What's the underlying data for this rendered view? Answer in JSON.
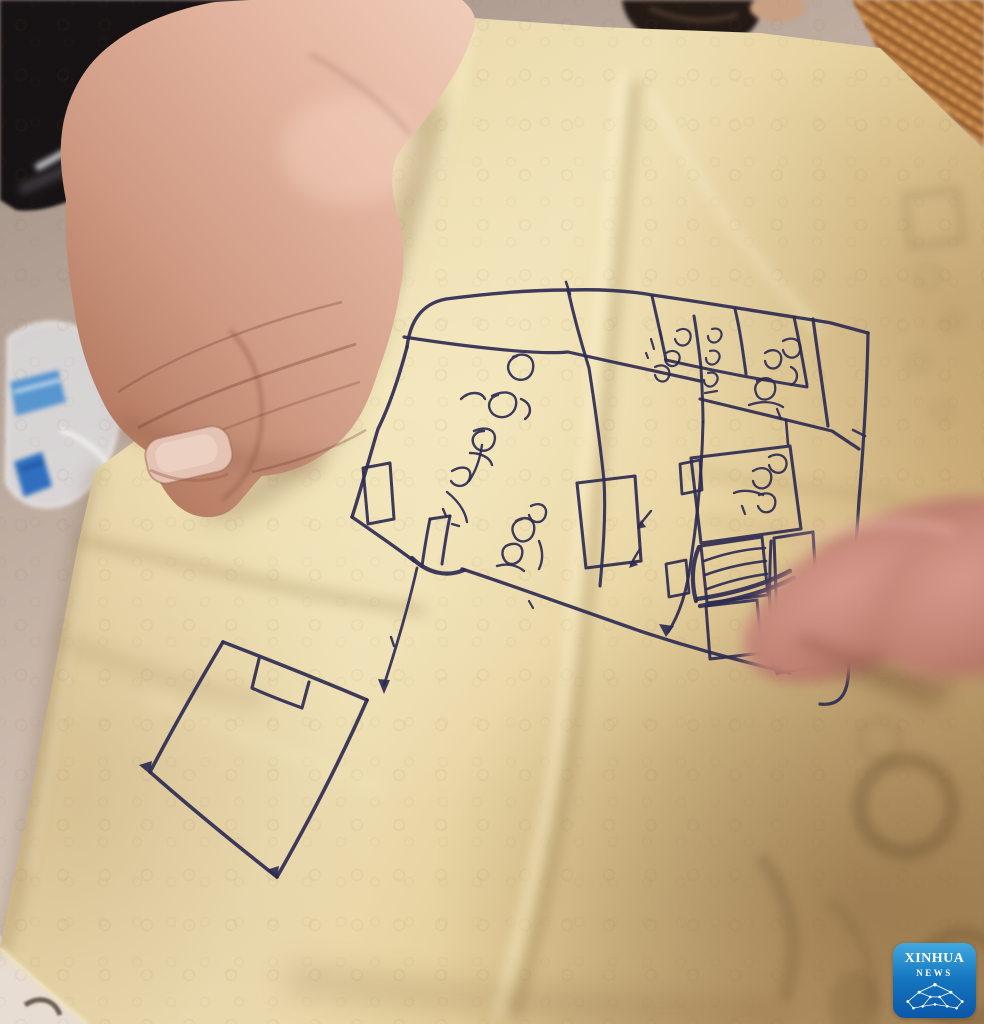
{
  "scene": {
    "subject": "hand holding a crumpled tan sheet of paper with a hand-drawn floor plan sketched in blue ballpoint ink, a blurred finger pointing at the sketch",
    "annotation_note": "room labels are illegible handwritten Burmese script"
  },
  "watermark": {
    "line1": "XINHUA",
    "line2": "NEWS"
  },
  "palette": {
    "ink": "#2e2b52",
    "paper": "#e6d3a4",
    "floor": "#c0aca0",
    "skin": "#d8a794",
    "hair": "#171214",
    "basket": "#b97c3f",
    "bottle_blue": "#4a8fd0",
    "logo_blue_top": "#41a8e0",
    "logo_blue_bottom": "#0b57a7",
    "ghost": "#5f4628"
  },
  "sketch": {
    "paths": [
      {
        "d": "M407,347 C410,323 420,304 446,299 C492,293 536,290 568,290",
        "w": 3.4
      },
      {
        "d": "M568,290 C602,289 630,291 652,295 C702,302 748,310 794,317 C806,319 821,321 831,323 L868,333",
        "w": 3.4
      },
      {
        "d": "M404,337 C468,347 540,355 568,352 C612,362 660,372 700,381",
        "w": 3.2
      },
      {
        "d": "M407,347 C399,377 389,407 378,429 C369,459 359,496 352,517",
        "w": 3.4
      },
      {
        "d": "M352,517 C378,535 398,549 414,561",
        "w": 3.4
      },
      {
        "d": "M462,569 C505,583 560,603 640,631 C685,646 725,657 790,673",
        "w": 3.4
      },
      {
        "d": "M568,290 C577,330 585,355 589,368 C597,420 601,450 604,481 C606,515 603,552 600,586",
        "w": 3.1
      },
      {
        "d": "M652,296 C657,318 662,340 666,360",
        "w": 3
      },
      {
        "d": "M694,316 C697,334 699,350 701,368",
        "w": 3
      },
      {
        "d": "M735,309 C740,330 743,352 746,374",
        "w": 3
      },
      {
        "d": "M794,317 C799,340 803,362 807,385",
        "w": 3
      },
      {
        "d": "M813,319 C818,355 823,392 828,426",
        "w": 3.2
      },
      {
        "d": "M666,360 C710,370 755,379 807,387",
        "w": 3
      },
      {
        "d": "M701,368 C702,386 703,404 703,422",
        "w": 3
      },
      {
        "d": "M700,399 C745,410 792,421 832,431 L859,449",
        "w": 3.2
      },
      {
        "d": "M868,333 C867,390 864,440 859,500 C855,560 852,625 848,678 C846,698 836,706 820,704",
        "w": 3.2
      },
      {
        "d": "M703,422 C702,470 697,520 691,560 C686,600 676,620 668,632",
        "w": 3
      },
      {
        "d": "M412,558 C428,574 448,577 464,570",
        "w": 4.2
      },
      {
        "d": "M363,468 L390,463 L394,519 L368,524 Z",
        "w": 3
      },
      {
        "d": "M430,519 C426,538 424,552 422,566",
        "w": 3
      },
      {
        "d": "M450,516 C446,535 444,550 442,564",
        "w": 3
      },
      {
        "d": "M430,519 L450,516",
        "w": 3
      },
      {
        "d": "M577,483 L635,476 L641,561 L586,568 Z",
        "w": 3.1
      },
      {
        "d": "M691,458 L790,446 L801,529 L701,543 Z",
        "w": 3.1
      },
      {
        "d": "M680,464 L700,460 L702,490 L682,494 Z",
        "w": 2.8
      },
      {
        "d": "M666,564 L686,560 L689,593 L669,597 Z",
        "w": 2.8
      },
      {
        "d": "M701,546 L762,537 L768,595 L707,603 Z",
        "w": 3
      },
      {
        "d": "M704,561 C726,553 748,549 765,548",
        "w": 2.6
      },
      {
        "d": "M705,575 C727,567 749,563 766,561",
        "w": 2.6
      },
      {
        "d": "M707,589 C729,581 751,576 767,574",
        "w": 2.6
      },
      {
        "d": "M697,599 C730,594 762,586 790,571",
        "w": 4.4
      },
      {
        "d": "M700,606 C735,600 766,592 794,578",
        "w": 4.4
      },
      {
        "d": "M699,547 C692,563 691,582 696,601",
        "w": 4.2
      },
      {
        "d": "M706,606 L757,600 L762,653 L710,659 Z",
        "w": 3
      },
      {
        "d": "M774,538 L813,532 L821,666 L779,673 Z",
        "w": 3.1
      },
      {
        "d": "M771,541 C769,580 769,625 774,669",
        "w": 3
      },
      {
        "d": "M223,642 C272,661 320,680 367,700",
        "w": 3.6
      },
      {
        "d": "M367,700 C341,759 310,819 277,877",
        "w": 3.6
      },
      {
        "d": "M277,877 C235,844 191,808 150,772",
        "w": 3.6
      },
      {
        "d": "M150,772 C173,728 198,684 223,642",
        "w": 3.6
      },
      {
        "d": "M259,659 L252,688 C269,696 286,702 302,708 L309,682",
        "w": 3.2
      },
      {
        "d": "M417,568 C408,608 396,648 384,685",
        "w": 2.8
      },
      {
        "d": "M391,637 l3,9",
        "w": 2.4
      },
      {
        "d": "M529,601 l4,7",
        "w": 2.2
      },
      {
        "d": "M566,282 l4,12",
        "w": 2.6
      },
      {
        "d": "M786,420 L788,444",
        "w": 2.6
      },
      {
        "d": "M853,430 l12,6",
        "w": 2.6
      },
      {
        "d": "M651,511 C646,517 642,522 639,526",
        "w": 2.4
      },
      {
        "d": "M640,549 C636,555 633,560 631,565",
        "w": 2.4
      },
      {
        "d": "M513,357 C525,351 535,357 533,369 C531,381 517,383 511,375 C505,367 509,359 517,356",
        "w": 2.4
      },
      {
        "d": "M492,396 C506,389 518,393 516,405 C514,417 500,421 492,413 C486,405 490,397 498,395",
        "w": 2.4
      },
      {
        "d": "M521,399 C531,403 533,413 525,419",
        "w": 2.4
      },
      {
        "d": "M461,399 C469,391 481,391 485,399",
        "w": 2.4
      },
      {
        "d": "M474,431 C488,425 498,431 494,443 C490,453 478,453 474,445 C470,437 476,431 484,431",
        "w": 2.4
      },
      {
        "d": "M482,445 C480,459 476,471 469,481",
        "w": 2.4
      },
      {
        "d": "M470,453 C480,453 490,457 492,465",
        "w": 2.4
      },
      {
        "d": "M452,471 C462,465 472,467 470,477 C468,487 456,489 451,481",
        "w": 2.4
      },
      {
        "d": "M447,492 C457,500 465,510 467,522",
        "w": 2.4
      },
      {
        "d": "M443,509 l3,7",
        "w": 2.4
      },
      {
        "d": "M452,524 l7,2",
        "w": 2.4
      },
      {
        "d": "M531,506 C541,501 549,507 545,517 C541,525 531,523 529,515",
        "w": 2.4
      },
      {
        "d": "M516,521 C526,515 536,519 534,531 C532,543 518,545 514,535 C510,527 514,521 522,519",
        "w": 2.4
      },
      {
        "d": "M506,546 C516,541 524,545 522,555 C520,565 508,567 504,559 C500,551 504,545 512,544",
        "w": 2.4
      },
      {
        "d": "M497,566 C507,563 517,565 524,571",
        "w": 2.4
      },
      {
        "d": "M539,541 C543,551 543,561 539,569",
        "w": 2.4
      },
      {
        "d": "M677,331 C685,326 693,331 690,340 C687,348 677,347 675,339",
        "w": 2.2
      },
      {
        "d": "M666,353 C674,348 682,353 679,361 C676,369 666,367 665,359",
        "w": 2.2
      },
      {
        "d": "M651,339 l3,10",
        "w": 2.2
      },
      {
        "d": "M660,331 l2,8",
        "w": 2.2
      },
      {
        "d": "M655,367 C663,363 671,367 669,376 C667,384 657,383 655,375",
        "w": 2.2
      },
      {
        "d": "M646,353 l2,5",
        "w": 2.2
      },
      {
        "d": "M712,329 C720,327 724,333 720,339 C716,345 708,343 708,336",
        "w": 2.2
      },
      {
        "d": "M710,351 C718,349 722,355 718,361 C714,367 706,365 706,358",
        "w": 2.2
      },
      {
        "d": "M708,373 C716,371 720,377 716,383 C712,389 704,387 704,380",
        "w": 2.2
      },
      {
        "d": "M705,393 l12,-2",
        "w": 2.2
      },
      {
        "d": "M783,341 C793,335 803,341 800,351 C797,361 785,359 783,350",
        "w": 2.3
      },
      {
        "d": "M765,353 C773,347 783,351 781,361 C779,371 767,371 765,361",
        "w": 2.3
      },
      {
        "d": "M791,367 C799,371 799,381 791,385",
        "w": 2.3
      },
      {
        "d": "M757,381 C767,375 777,379 775,391 C773,401 759,403 756,393 C753,385 759,379 767,379",
        "w": 2.3
      },
      {
        "d": "M749,405 C761,401 773,401 783,407",
        "w": 2.3
      },
      {
        "d": "M777,409 l4,10",
        "w": 2.3
      },
      {
        "d": "M769,457 C779,451 789,457 786,467 C783,476 771,474 769,465",
        "w": 2.3
      },
      {
        "d": "M753,471 C763,465 773,469 771,480 C769,491 755,491 753,481",
        "w": 2.3
      },
      {
        "d": "M759,495 C769,491 777,495 775,505 C773,514 761,515 758,506",
        "w": 2.3
      },
      {
        "d": "M734,493 C744,489 754,491 763,495",
        "w": 2.3
      },
      {
        "d": "M742,506 l3,8",
        "w": 2.3
      }
    ],
    "arrows": [
      "M384,694 L378,679 L390,680 Z",
      "M150,774 L139,765 L152,761 Z",
      "M277,879 L266,870 L279,866 Z",
      "M666,637 L659,624 L674,626 Z",
      "M777,676 L770,663 L784,665 Z",
      "M637,529 L646,527 L641,520 Z",
      "M629,568 L638,565 L633,559 Z"
    ]
  },
  "paper": {
    "creases": [
      {
        "d": "M622,75 C603,260 588,440 574,600 C560,770 528,910 498,1012",
        "c": "rgba(255,244,210,0.55)",
        "w": 10,
        "b": 6
      },
      {
        "d": "M636,85 C618,270 602,450 588,610 C574,780 545,915 516,1015",
        "c": "rgba(120,88,45,0.28)",
        "w": 9,
        "b": 6
      },
      {
        "d": "M82,540 C190,565 320,598 420,610",
        "c": "rgba(120,88,45,0.25)",
        "w": 10,
        "b": 7
      },
      {
        "d": "M472,30 C452,120 428,220 398,320",
        "c": "rgba(255,244,210,0.5)",
        "w": 8,
        "b": 6
      },
      {
        "d": "M652,95 C690,170 745,255 820,330",
        "c": "rgba(255,246,215,0.45)",
        "w": 7,
        "b": 6
      },
      {
        "d": "M690,470 C760,483 840,494 900,498",
        "c": "rgba(120,88,45,0.16)",
        "w": 8,
        "b": 7
      },
      {
        "d": "M705,520 C770,532 850,545 910,552",
        "c": "rgba(120,88,45,0.12)",
        "w": 8,
        "b": 7
      },
      {
        "d": "M60,640 C120,665 200,690 260,700",
        "c": "rgba(120,88,45,0.18)",
        "w": 12,
        "b": 9
      },
      {
        "d": "M150,700 C230,730 310,760 380,790",
        "c": "rgba(250,238,200,0.3)",
        "w": 10,
        "b": 8
      },
      {
        "d": "M96,472 C70,580 46,720 18,880 C10,920 4,940 0,948",
        "c": "rgba(115,85,50,0.30)",
        "w": 12,
        "b": 8
      },
      {
        "d": "M104,474 C80,580 58,716 30,870",
        "c": "rgba(250,240,205,0.35)",
        "w": 6,
        "b": 5
      },
      {
        "d": "M2,950 C30,976 58,1000 86,1022",
        "c": "rgba(240,226,184,0.8)",
        "w": 5,
        "b": 2
      }
    ],
    "shadows": [
      {
        "d": "M430,110 C410,210 378,320 336,415 C310,462 268,496 215,509",
        "c": "rgba(92,62,30,0.32)",
        "w": 22,
        "b": 12
      },
      {
        "d": "M788,636 C836,660 884,682 930,700",
        "c": "rgba(92,62,30,0.30)",
        "w": 20,
        "b": 10
      },
      {
        "d": "M300,980 C450,1000 620,1010 780,1015",
        "c": "rgba(110,80,45,0.18)",
        "w": 30,
        "b": 14
      }
    ],
    "ghosts": [
      {
        "d": "M860,806 a46,46 0 1 0 92,0 a46,46 0 1 0 -92,0",
        "sw": 16,
        "o": 0.3
      },
      {
        "d": "M918,978 a44,44 0 1 0 88,0 a44,44 0 1 0 -88,0",
        "sw": 15,
        "o": 0.28
      },
      {
        "d": "M760,856 C792,898 802,948 784,1000",
        "sw": 14,
        "o": 0.22
      },
      {
        "d": "M830,900 C860,930 880,970 870,1010",
        "sw": 12,
        "o": 0.15
      },
      {
        "d": "M829,1006 a26,36 0 1 0 52,0 a26,36 0 1 0 -52,0",
        "sw": 0,
        "o": 0.18
      },
      {
        "d": "M905,196 l52,-6 l6,50 l-52,7 Z",
        "sw": 8,
        "o": 0.14
      },
      {
        "d": "M917,276 a11,11 0 1 0 22,0 a11,11 0 1 0 -22,0",
        "sw": 5,
        "o": 0.1
      },
      {
        "d": "M943,322 a9,9 0 1 0 18,0 a9,9 0 1 0 -18,0",
        "sw": 5,
        "o": 0.1
      },
      {
        "d": "M908,362 a10,10 0 1 0 20,0 a10,10 0 1 0 -20,0",
        "sw": 5,
        "o": 0.1
      },
      {
        "d": "M933,412 a9,9 0 1 0 18,0 a9,9 0 1 0 -18,0",
        "sw": 5,
        "o": 0.1
      },
      {
        "d": "M860,740 a20,20 0 1 0 40,0 a20,20 0 1 0 -40,0",
        "sw": 8,
        "o": 0.12
      }
    ]
  }
}
